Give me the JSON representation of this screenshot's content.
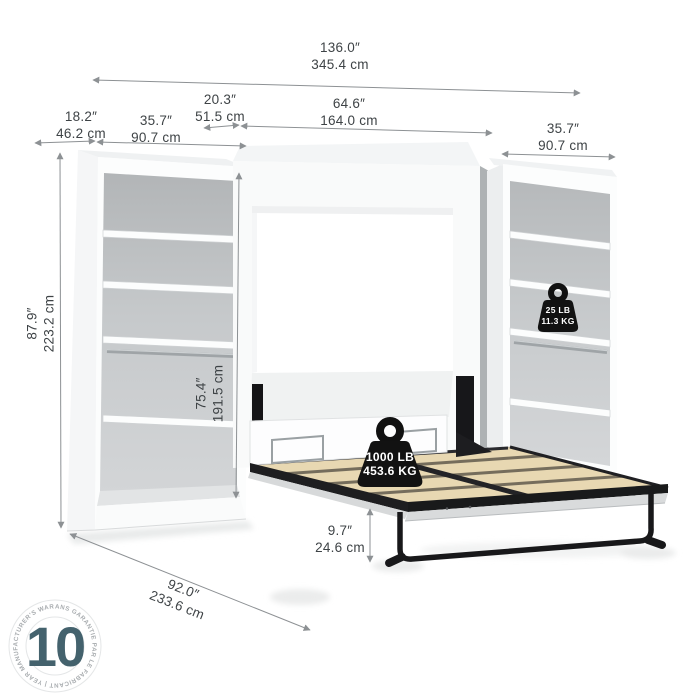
{
  "title": "Wall bed with two shelving units - dimension diagram",
  "dimensions": {
    "overall_width": {
      "in": "136.0″",
      "cm": "345.4 cm"
    },
    "left_unit_depth": {
      "in": "18.2″",
      "cm": "46.2 cm"
    },
    "left_unit_width": {
      "in": "35.7″",
      "cm": "90.7 cm"
    },
    "cabinet_depth": {
      "in": "20.3″",
      "cm": "51.5 cm"
    },
    "bed_width": {
      "in": "64.6″",
      "cm": "164.0 cm"
    },
    "right_unit_width": {
      "in": "35.7″",
      "cm": "90.7 cm"
    },
    "overall_height": {
      "in": "87.9″",
      "cm": "223.2 cm"
    },
    "interior_height": {
      "in": "75.4″",
      "cm": "191.5 cm"
    },
    "bed_frame_height": {
      "in": "9.7″",
      "cm": "24.6 cm"
    },
    "open_depth": {
      "in": "92.0″",
      "cm": "233.6 cm"
    }
  },
  "capacities": {
    "shelf": {
      "lb": "25 LB",
      "kg": "11.3 KG"
    },
    "bed": {
      "lb": "1000 LB",
      "kg": "453.6 KG"
    }
  },
  "badge": {
    "years": "10",
    "ring_text": "ANS GARANTIE PAR LE FABRICANT  |  YEAR MANUFACTURER'S WARRANTY  |"
  },
  "colors": {
    "badge_teal": "#44626d",
    "slat_wood": "#e8d8b2",
    "slat_gap": "#756d5c",
    "metal_black": "#1a1a1c",
    "interior_gray": "#c3c6c8",
    "dim_line": "#8d9194",
    "dim_text": "#3e4346"
  }
}
